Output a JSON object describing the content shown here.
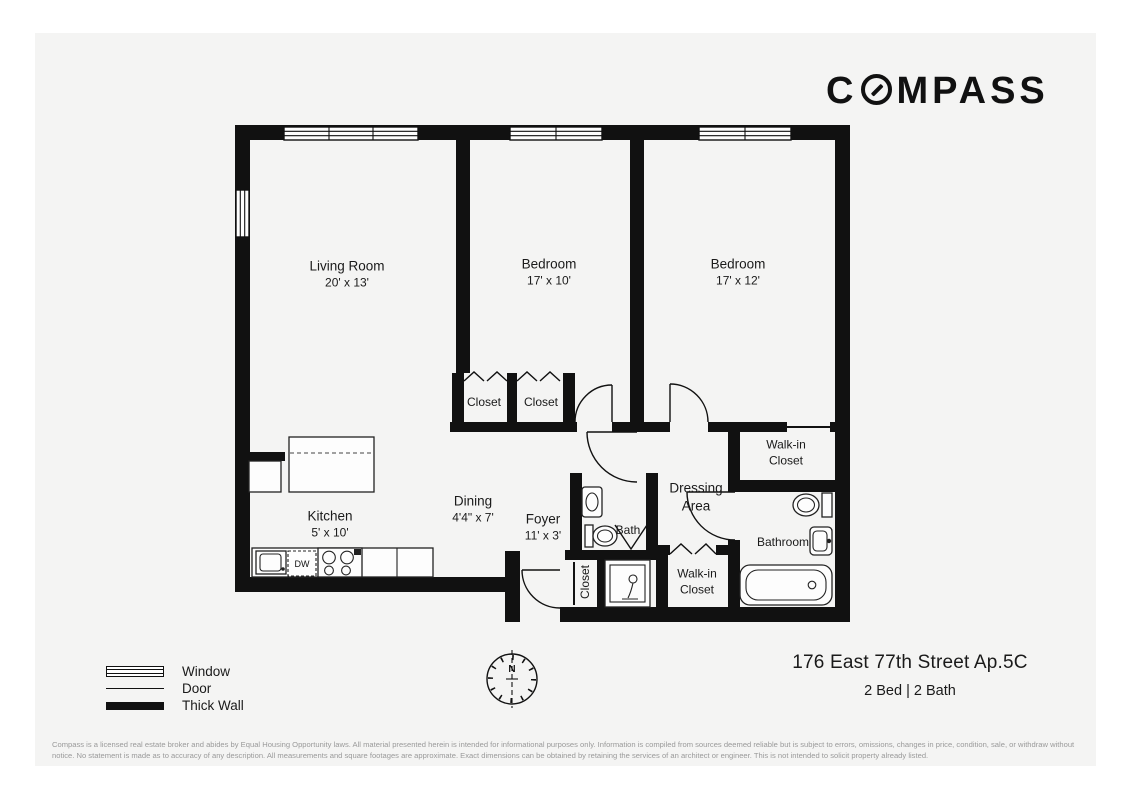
{
  "brand": {
    "logo_prefix": "C",
    "logo_suffix": "MPASS"
  },
  "labels": {
    "living": {
      "name": "Living Room",
      "dims": "20' x 13'"
    },
    "bedroom1": {
      "name": "Bedroom",
      "dims": "17' x 10'"
    },
    "bedroom2": {
      "name": "Bedroom",
      "dims": "17' x 12'"
    },
    "closet1": {
      "name": "Closet"
    },
    "closet2": {
      "name": "Closet"
    },
    "walkin_top": {
      "name": "Walk-in Closet"
    },
    "dressing": {
      "name": "Dressing Area"
    },
    "bath": {
      "name": "Bath"
    },
    "bathroom": {
      "name": "Bathroom"
    },
    "walkin_bottom": {
      "name": "Walk-in Closet"
    },
    "foyer_closet": {
      "name": "Closet"
    },
    "foyer": {
      "name": "Foyer",
      "dims": "11' x 3'"
    },
    "dining": {
      "name": "Dining",
      "dims": "4'4\" x 7'"
    },
    "kitchen": {
      "name": "Kitchen",
      "dims": "5' x 10'",
      "dw_label": "DW"
    }
  },
  "compass": {
    "north_label": "N"
  },
  "legend": {
    "window": "Window",
    "door": "Door",
    "thick_wall": "Thick Wall"
  },
  "footer": {
    "address": "176 East 77th Street Ap.5C",
    "beds_baths": "2 Bed | 2 Bath",
    "disclaimer": "Compass is a licensed real estate broker and abides by Equal Housing Opportunity laws. All material presented herein is intended for informational purposes only. Information is compiled from sources deemed reliable but is subject to errors, omissions, changes in price, condition, sale, or withdraw without notice. No statement is made as to accuracy of any description. All measurements and square footages are approximate. Exact dimensions can be obtained by retaining the services of an architect or engineer. This is not intended to solicit property already listed."
  },
  "colors": {
    "wall": "#111111",
    "card_background": "#f4f4f3",
    "page_background": "#ffffff",
    "disclaimer_gray": "#9a9a9a"
  }
}
